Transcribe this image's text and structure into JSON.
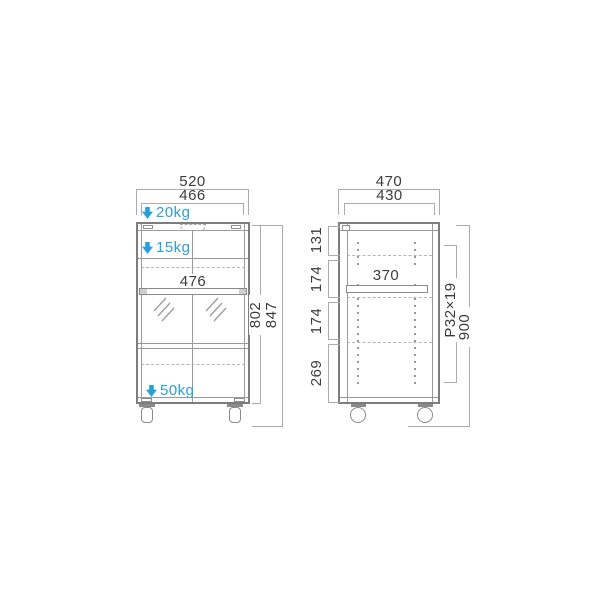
{
  "diagram_title": "cabinet-dimension-drawing",
  "front_view": {
    "outer_width": "520",
    "inner_width": "466",
    "top_load": "20kg",
    "shelf_load": "15kg",
    "shelf_width": "476",
    "bottom_load": "50kg",
    "body_height": "802",
    "total_height": "847"
  },
  "side_view": {
    "outer_depth": "470",
    "inner_depth": "430",
    "shelf_depth": "370",
    "segments": [
      "131",
      "174",
      "174",
      "269"
    ],
    "hole_pitch": "P32×19",
    "total_height": "900"
  },
  "colors": {
    "accent_blue": "#29a0d8",
    "cabinet_line": "#7d7d7d",
    "dim_line": "#ababab",
    "text": "#3c3c3c"
  }
}
